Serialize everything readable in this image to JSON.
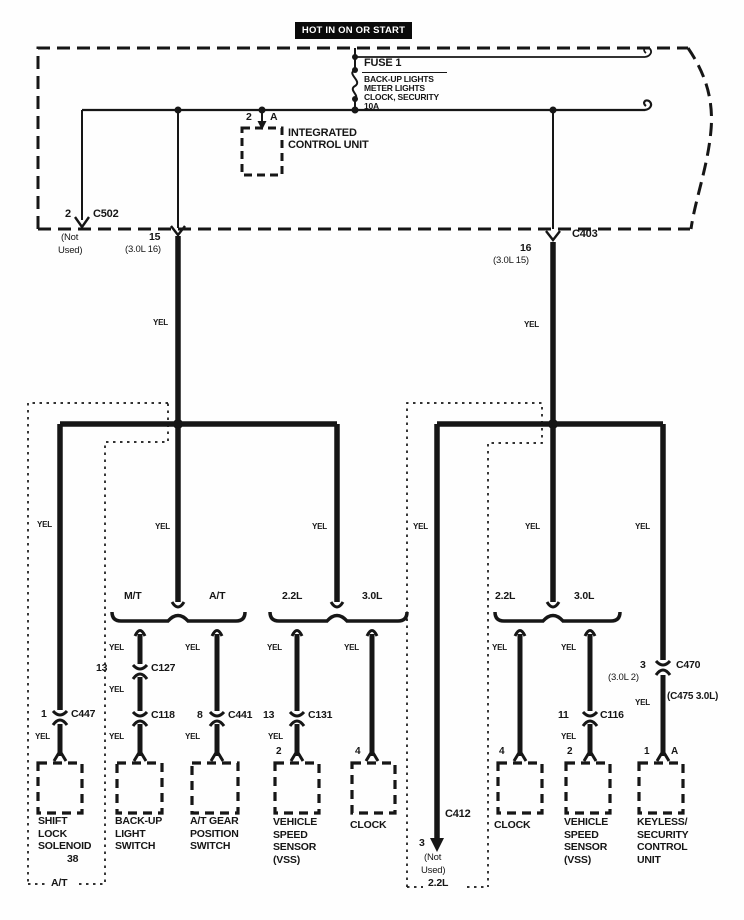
{
  "header": {
    "title": "HOT IN ON OR START"
  },
  "wire": {
    "color": "YEL"
  },
  "fuse": {
    "name": "FUSE 1",
    "line1": "BACK-UP LIGHTS",
    "line2": "METER LIGHTS",
    "line3": "CLOCK, SECURITY",
    "line4": "10A"
  },
  "icu": {
    "pin": "2",
    "terminal": "A",
    "name1": "INTEGRATED",
    "name2": "CONTROL UNIT"
  },
  "c502": {
    "pin": "2",
    "name": "C502",
    "note1": "(Not",
    "note2": "Used)"
  },
  "j15": {
    "pin": "15",
    "alt": "(3.0L 16)"
  },
  "c403": {
    "name": "C403",
    "pin": "16",
    "alt": "(3.0L 15)"
  },
  "c127": {
    "pin": "13",
    "name": "C127"
  },
  "c118": {
    "name": "C118"
  },
  "c441": {
    "pin": "8",
    "name": "C441"
  },
  "c131": {
    "pin": "13",
    "name": "C131"
  },
  "c447": {
    "pin": "1",
    "name": "C447"
  },
  "c116": {
    "pin": "11",
    "name": "C116"
  },
  "c470": {
    "pin": "3",
    "name": "C470",
    "alt": "(3.0L 2)",
    "alt2": "(C475 3.0L)"
  },
  "c412": {
    "name": "C412",
    "pin": "3",
    "note1": "(Not",
    "note2": "Used)"
  },
  "groups": {
    "mt": "M/T",
    "at": "A/T",
    "eng22_left": "2.2L",
    "eng30_left": "3.0L",
    "eng22_right": "2.2L",
    "eng30_right": "3.0L"
  },
  "variants": {
    "at_box": "A/T",
    "l22_box": "2.2L"
  },
  "pins": {
    "vss_left": "2",
    "clock_left": "4",
    "clock_right": "4",
    "vss_right": "2",
    "keyless_pin": "1",
    "keyless_terminal": "A"
  },
  "components": {
    "shift_lock": {
      "l1": "SHIFT",
      "l2": "LOCK",
      "l3": "SOLENOID",
      "l4": "38"
    },
    "backup_switch": {
      "l1": "BACK-UP",
      "l2": "LIGHT",
      "l3": "SWITCH"
    },
    "at_gear": {
      "l1": "A/T GEAR",
      "l2": "POSITION",
      "l3": "SWITCH"
    },
    "vss_left": {
      "l1": "VEHICLE",
      "l2": "SPEED",
      "l3": "SENSOR",
      "l4": "(VSS)"
    },
    "clock_left": {
      "l1": "CLOCK"
    },
    "clock_right": {
      "l1": "CLOCK"
    },
    "vss_right": {
      "l1": "VEHICLE",
      "l2": "SPEED",
      "l3": "SENSOR",
      "l4": "(VSS)"
    },
    "keyless": {
      "l1": "KEYLESS/",
      "l2": "SECURITY",
      "l3": "CONTROL",
      "l4": "UNIT"
    }
  },
  "colors": {
    "ink": "#161616",
    "paper": "#fefefe",
    "header_bg": "#0a0a0a",
    "header_fg": "#ffffff"
  }
}
